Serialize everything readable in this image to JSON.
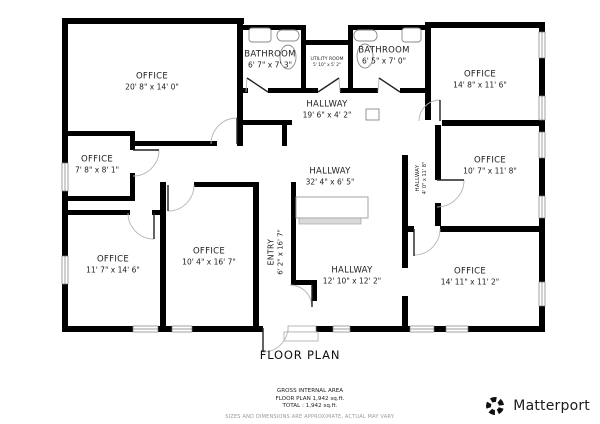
{
  "title": "FLOOR PLAN",
  "rooms": [
    {
      "name": "OFFICE",
      "dims": "20' 8\" x 14' 0\""
    },
    {
      "name": "BATHROOM",
      "dims": "6' 7\" x 7' 3\""
    },
    {
      "name": "UTILITY ROOM",
      "dims": "5' 10\" x 5' 2\""
    },
    {
      "name": "BATHROOM",
      "dims": "6' 5\" x 7' 0\""
    },
    {
      "name": "OFFICE",
      "dims": "14' 8\" x 11' 6\""
    },
    {
      "name": "HALLWAY",
      "dims": "19' 6\" x 4' 2\""
    },
    {
      "name": "OFFICE",
      "dims": "7' 8\" x 8' 1\""
    },
    {
      "name": "HALLWAY",
      "dims": "32' 4\" x 6' 5\""
    },
    {
      "name": "OFFICE",
      "dims": "10' 7\" x 11' 8\""
    },
    {
      "name": "HALLWAY",
      "dims": "4' 0\" x 11' 8\""
    },
    {
      "name": "OFFICE",
      "dims": "11' 7\" x 14' 6\""
    },
    {
      "name": "OFFICE",
      "dims": "10' 4\" x 16' 7\""
    },
    {
      "name": "ENTRY",
      "dims": "6' 2\" x 16' 7\""
    },
    {
      "name": "HALLWAY",
      "dims": "12' 10\" x 12' 2\""
    },
    {
      "name": "OFFICE",
      "dims": "14' 11\" x 11' 2\""
    }
  ],
  "footer": {
    "area_heading": "GROSS INTERNAL AREA",
    "area_line1": "FLOOR PLAN 1,942 sq.ft.",
    "area_line2": "TOTAL :  1,942 sq.ft.",
    "disclaimer": "SIZES AND DIMENSIONS ARE APPROXIMATE, ACTUAL MAY VARY."
  },
  "branding": {
    "logo_text": "Matterport",
    "logo_icon": "matterport-pinwheel-icon"
  },
  "colors": {
    "wall": "#000000",
    "text": "#1c1c1c",
    "muted": "#9a9a9a",
    "door_arc": "#b5b5b5"
  }
}
